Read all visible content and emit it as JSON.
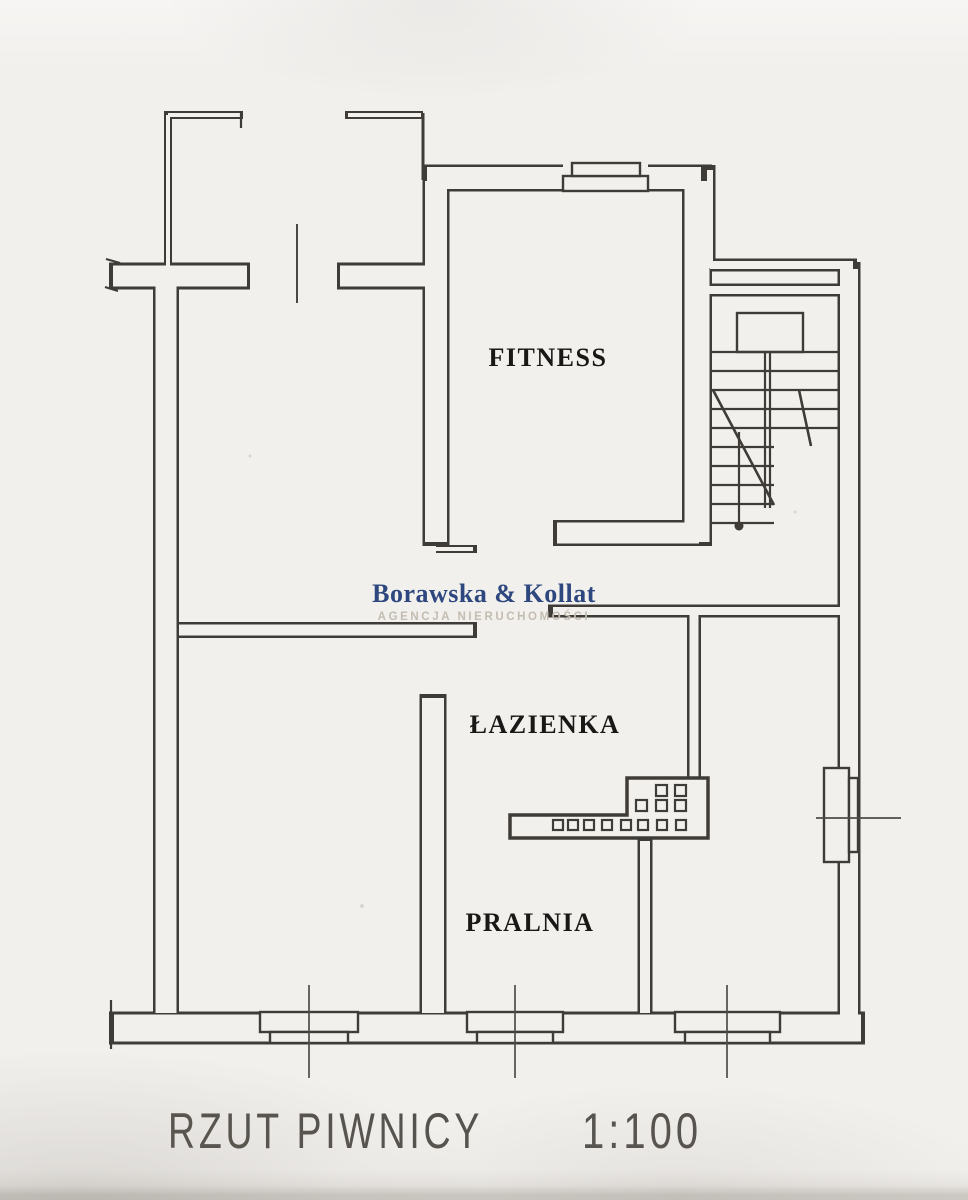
{
  "watermark": {
    "brand": "Borawska & Kollat",
    "tagline": "AGENCJA NIERUCHOMOŚCI",
    "brand_color": "#24407a",
    "tagline_color": "#c3bcb1"
  },
  "rooms": {
    "fitness": "FITNESS",
    "bathroom": "ŁAZIENKA",
    "laundry": "PRALNIA"
  },
  "caption": {
    "title": "RZUT PIWNICY",
    "scale": "1:100"
  },
  "style": {
    "ink": "#3f3c38",
    "paper": "#f2f0ed"
  }
}
